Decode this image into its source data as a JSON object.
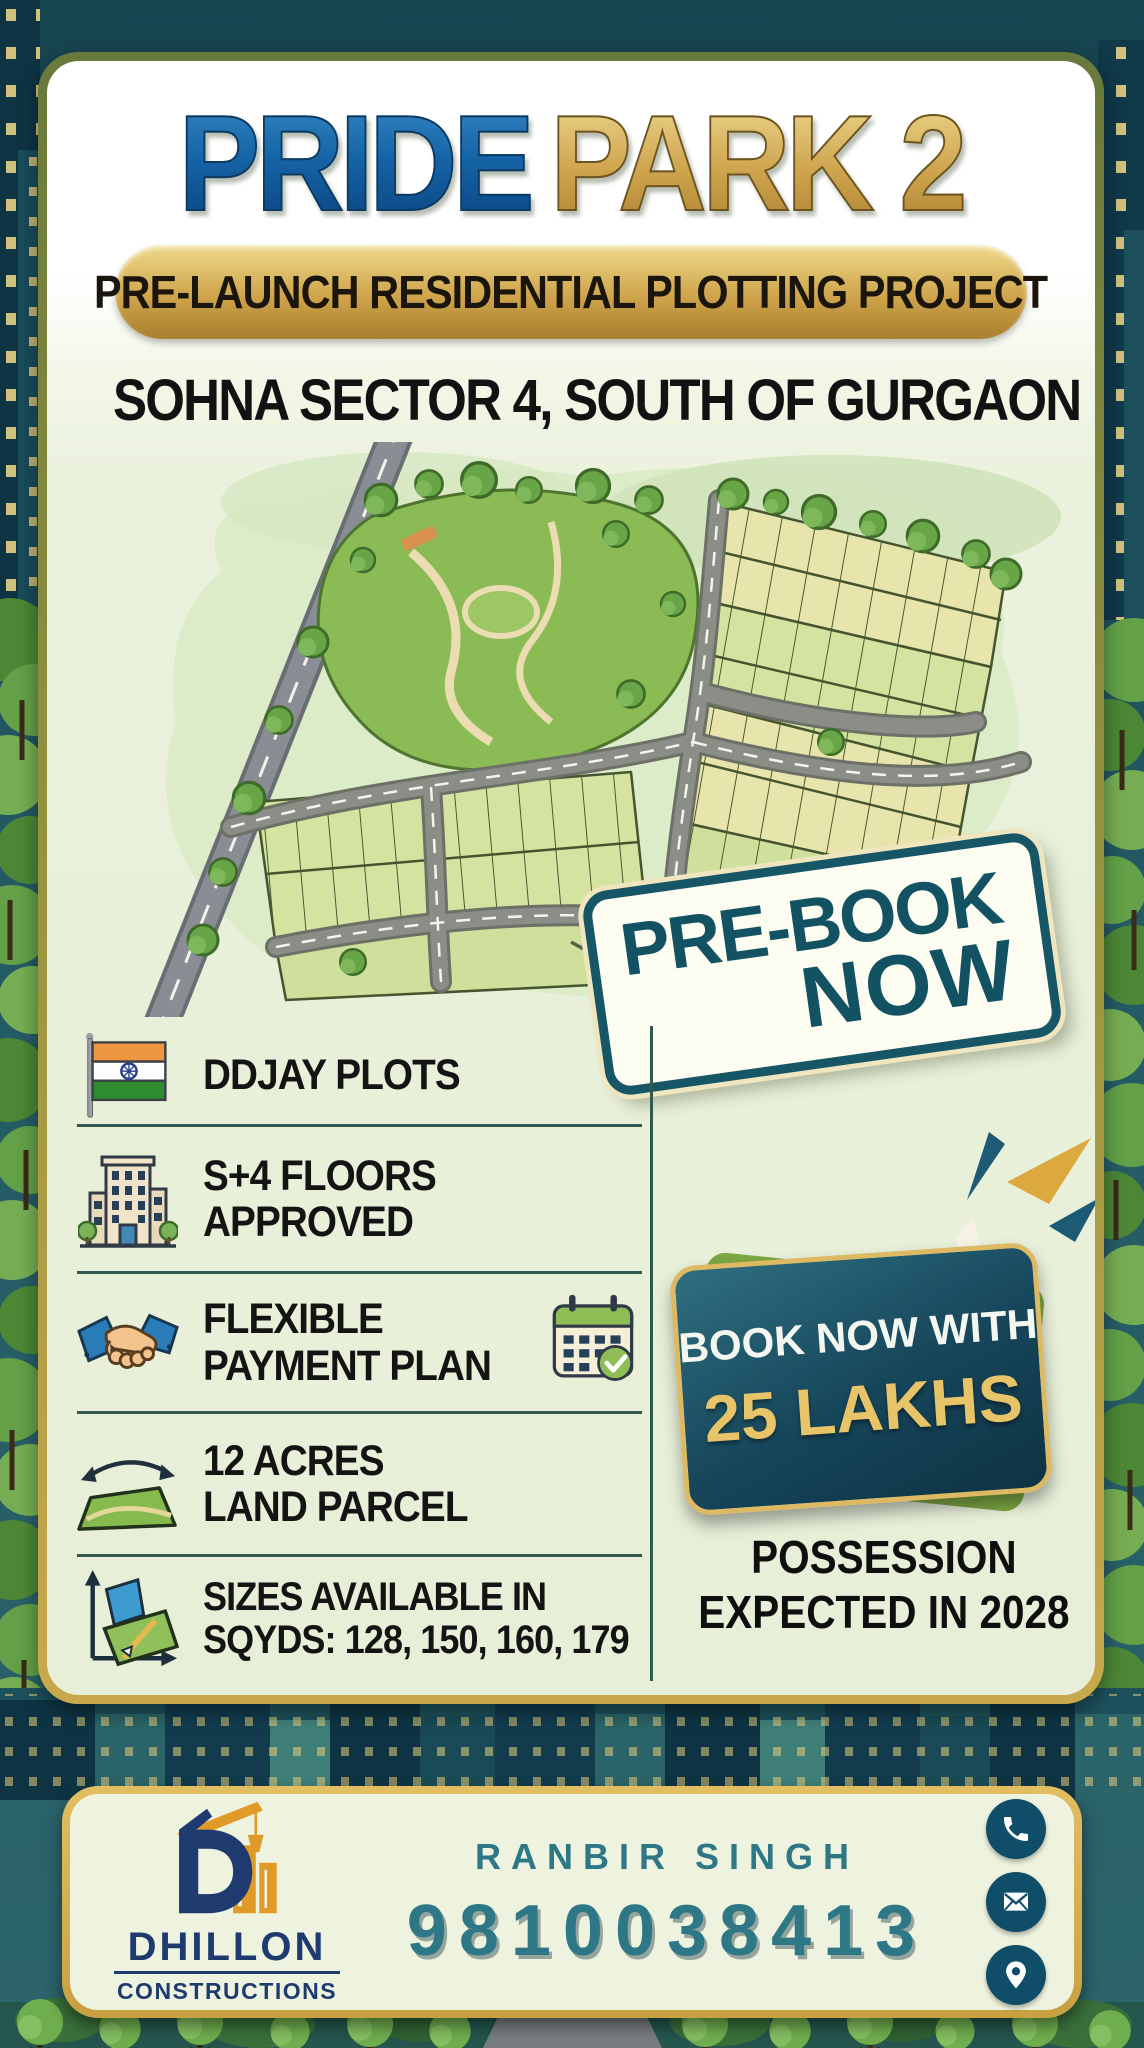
{
  "poster": {
    "title": {
      "part1": "PRIDE",
      "part2": "PARK 2"
    },
    "subtitle_banner": "PRE-LAUNCH RESIDENTIAL PLOTTING PROJECT",
    "location_heading": "SOHNA SECTOR 4, SOUTH OF GURGAON",
    "prebook_badge": {
      "line1": "PRE-BOOK",
      "line2": "NOW"
    },
    "features": [
      {
        "icon": "india-flag-icon",
        "line1": "DDJAY PLOTS",
        "line2": ""
      },
      {
        "icon": "apartment-building-icon",
        "line1": "S+4 FLOORS",
        "line2": "APPROVED"
      },
      {
        "icon": "handshake-icon",
        "line1": "FLEXIBLE",
        "line2": "PAYMENT PLAN",
        "trailing_icon": "calendar-check-icon"
      },
      {
        "icon": "land-area-icon",
        "line1": "12 ACRES",
        "line2": "LAND PARCEL"
      },
      {
        "icon": "plot-size-icon",
        "line1": "SIZES AVAILABLE IN",
        "line2": "SQYDS: 128, 150, 160, 179"
      }
    ],
    "offer_badge": {
      "line1": "BOOK NOW WITH",
      "line2": "25 LAKHS"
    },
    "possession": {
      "line1": "POSSESSION",
      "line2": "EXPECTED IN 2028"
    },
    "footer": {
      "logo": {
        "company_line1": "DHILLON",
        "company_line2": "CONSTRUCTIONS"
      },
      "agent_name": "RANBIR SINGH",
      "phone_number": "9810038413",
      "contact_icons": [
        "phone-icon",
        "email-icon",
        "location-pin-icon"
      ]
    },
    "colors": {
      "title_blue": "#1565a8",
      "title_gold": "#cfa44e",
      "banner_gold": "#d9b45e",
      "prebook_teal": "#175666",
      "offer_navy": "#16455a",
      "offer_gold": "#e8c469",
      "text_black": "#141414",
      "footer_teal": "#2d7787",
      "logo_navy": "#1e3a6e",
      "card_green": "#eaf1dc",
      "border_olive_gold": "#93913f"
    }
  }
}
